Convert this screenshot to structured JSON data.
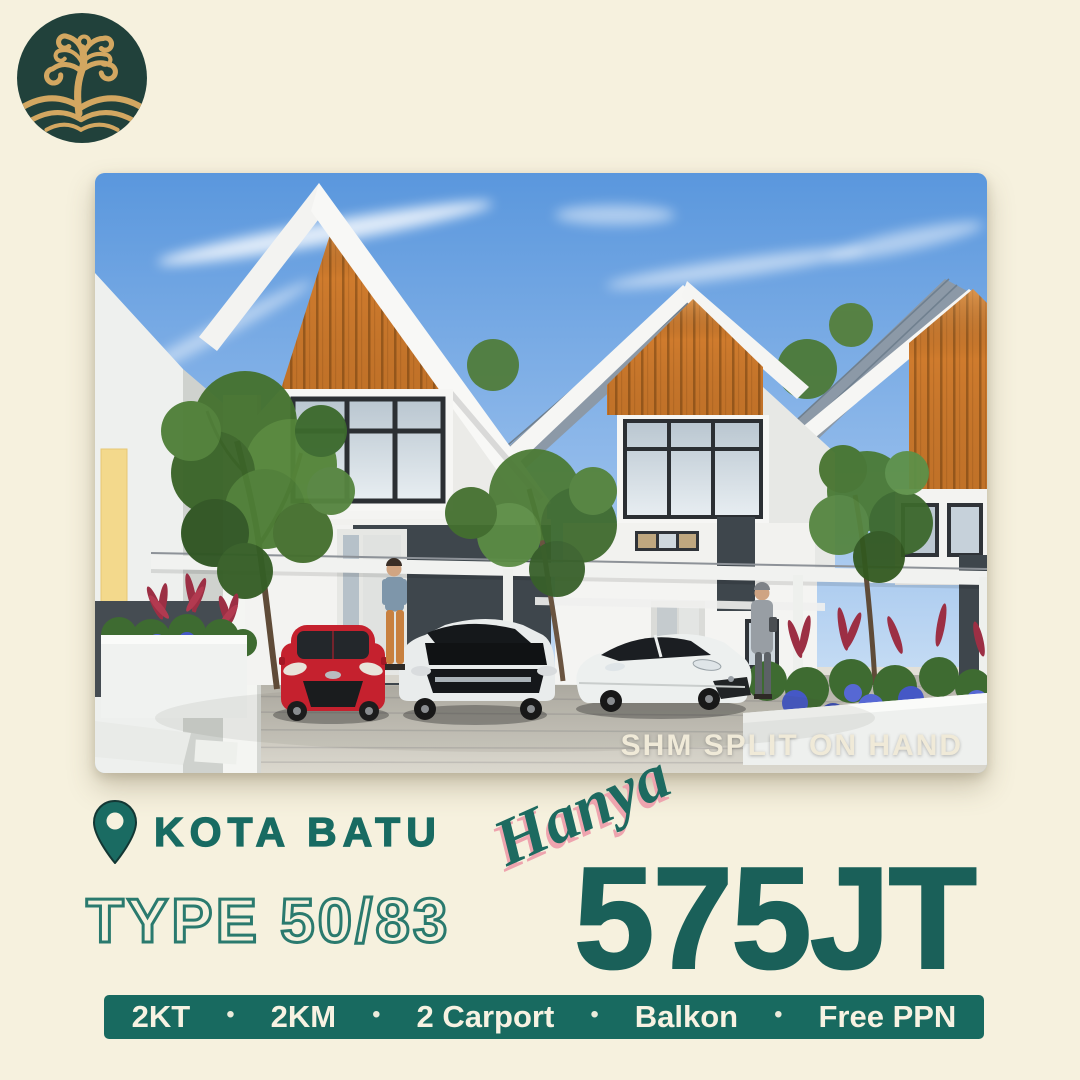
{
  "photo": {
    "overlay_text": "SHM SPLIT ON HAND"
  },
  "location": {
    "label": "KOTA BATU"
  },
  "type_label": "TYPE 50/83",
  "price": {
    "script_label": "Hanya",
    "value": "575JT"
  },
  "features": {
    "items": [
      "2KT",
      "2KM",
      "2 Carport",
      "Balkon",
      "Free PPN"
    ],
    "separator": "•"
  },
  "icons": {
    "logo": "tree-logo",
    "location": "location-pin-icon"
  },
  "colors": {
    "background": "#f6f1de",
    "teal_text": "#186b62",
    "teal_dark": "#1a6059",
    "bar_background": "#186a60",
    "bar_text": "#f7f2e2",
    "script_pink_shadow": "#eea4ae",
    "logo_circle": "#21413b",
    "logo_gold": "#d3a761",
    "house_accent_orange": "#cf7b2d"
  }
}
